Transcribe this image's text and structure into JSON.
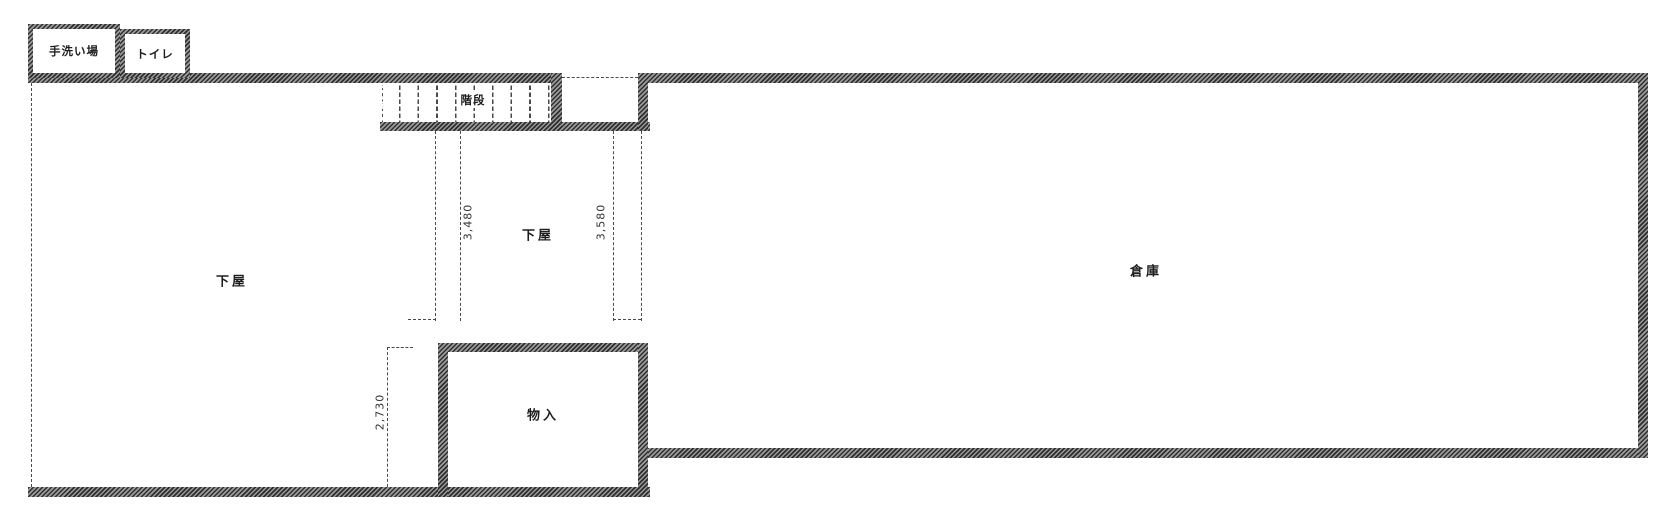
{
  "drawing": {
    "type": "floor-plan",
    "rooms": {
      "hand_wash": "手洗い場",
      "toilet": "トイレ",
      "stairs": "階段",
      "lean_to_left": "下屋",
      "lean_to_center": "下屋",
      "storage": "物入",
      "warehouse": "倉庫"
    },
    "dimensions": {
      "center_left": "3,480",
      "center_right": "3,580",
      "lower_left": "2,730"
    }
  },
  "colors": {
    "wall_dark": "#2f2f2f",
    "wall_light": "#9a9a9a",
    "line": "#4a4a4a",
    "background": "#ffffff",
    "text": "#1e1e1e"
  }
}
